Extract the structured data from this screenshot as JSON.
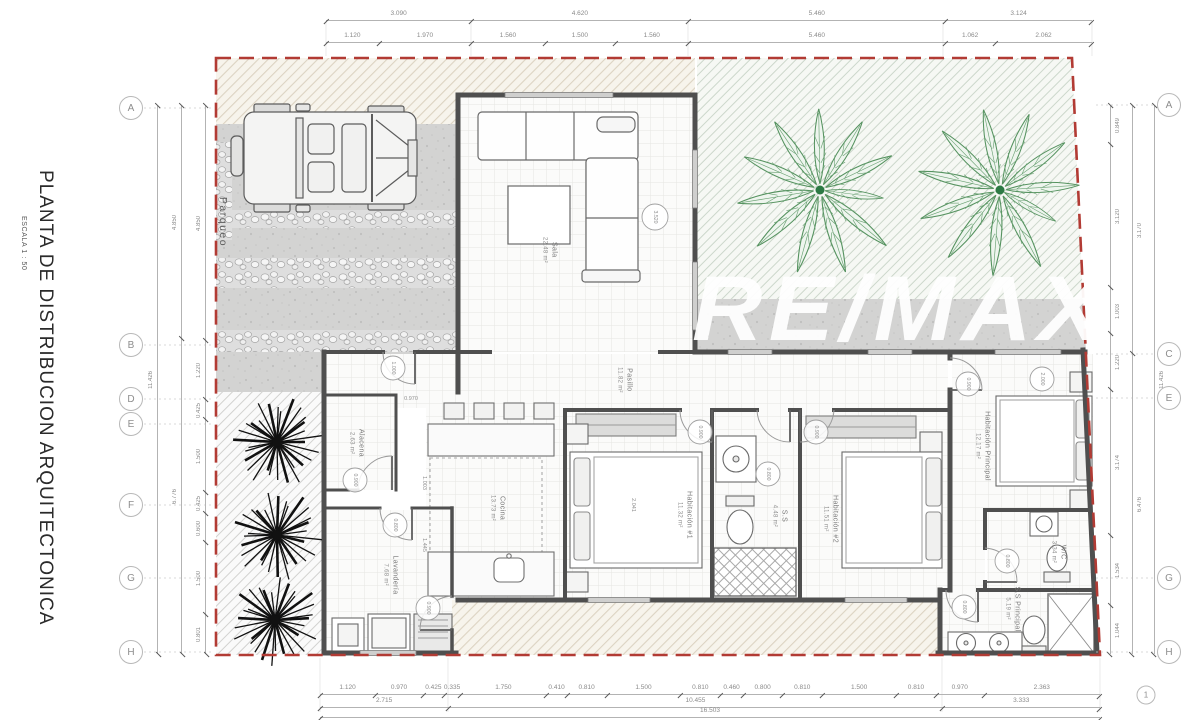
{
  "page": {
    "title": "PLANTA DE DISTRIBUCION ARQUITECTONICA",
    "scale": "ESCALA 1 : 50",
    "watermark": "RE/MAX"
  },
  "grid_bubbles": {
    "left": [
      "A",
      "B",
      "D",
      "E",
      "F",
      "G",
      "H"
    ],
    "right": [
      "A",
      "C",
      "E",
      "G",
      "H"
    ],
    "bottom_right": "1"
  },
  "dims": {
    "top1": [
      "3.090",
      "4.620",
      "5.460",
      "3.124"
    ],
    "top2": [
      "1.120",
      "1.970",
      "1.560",
      "1.500",
      "1.560",
      "5.460",
      "1.062",
      "2.062"
    ],
    "bottom1": [
      "1.120",
      "0.970",
      "0.425",
      "0.335",
      "1.750",
      "0.410",
      "0.810",
      "1.500",
      "0.810",
      "0.460",
      "0.800",
      "0.810",
      "1.500",
      "0.810",
      "0.970",
      "2.363"
    ],
    "bottom2": [
      "2.715",
      "10.455",
      "3.333"
    ],
    "bottom3": [
      "16.503"
    ],
    "left_outer": [
      "11.426"
    ],
    "left_mid": [
      "4.850",
      "6.776"
    ],
    "left_inner": [
      "4.850",
      "1.220",
      "0.425",
      "1.500",
      "0.425",
      "0.600",
      "1.500",
      "0.801"
    ],
    "right_outer": [
      "11.426"
    ],
    "right_mid": [
      "3.170",
      "6.476"
    ],
    "right_inner": [
      "0.849",
      "3.120",
      "1.003",
      "1.220",
      "3.174",
      "1.534",
      "1.044"
    ]
  },
  "rooms": {
    "parqueo": {
      "name": "Parqueo",
      "area": ""
    },
    "sala": {
      "name": "Sala",
      "area": "22.48 m²"
    },
    "pasillo": {
      "name": "Pasillo",
      "area": "11.82 m²"
    },
    "alacena": {
      "name": "Alacena",
      "area": "2.63 m²"
    },
    "cocina": {
      "name": "Cocina",
      "area": "13.73 m²"
    },
    "lavanderia": {
      "name": "Lavandería",
      "area": "7.68 m²"
    },
    "hab1": {
      "name": "Habitación #1",
      "area": "11.32 m²"
    },
    "ss": {
      "name": "S.S",
      "area": "4.48 m²"
    },
    "hab2": {
      "name": "Habitación #2",
      "area": "11.51 m²"
    },
    "principal": {
      "name": "Habitación Principal",
      "area": "12.17 m²"
    },
    "wc": {
      "name": "W/C",
      "area": "3.34 m²"
    },
    "ssp": {
      "name": "S.S Principal",
      "area": "5.19 m²"
    }
  },
  "door_tags": [
    "1.000",
    "0.900",
    "0.800",
    "0.900",
    "0.900",
    "0.800",
    "0.900",
    "0.900",
    "2.000",
    "0.800",
    "0.800",
    "3.520"
  ],
  "interior_dims": [
    "0.970",
    "1.003",
    "1.445",
    "2.041"
  ],
  "colors": {
    "boundary_red": "#b23b34",
    "wall_gray": "#4f4f4f",
    "concrete": "#d3d3d2",
    "palm_green": "#55925f",
    "dim_text": "#8a8a8a",
    "watermark": "#ffffff"
  }
}
